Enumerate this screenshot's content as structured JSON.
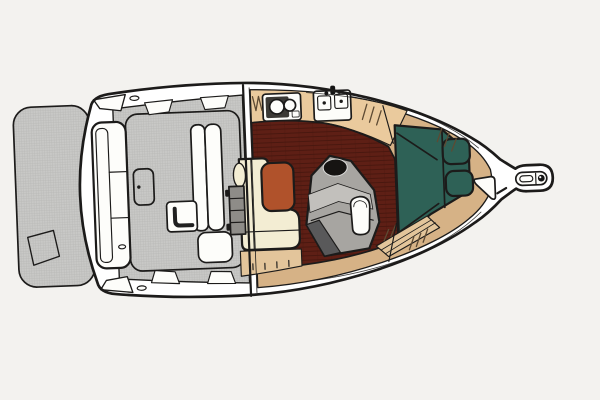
{
  "title": "Motor yacht deck and cabin floor plan (top view)",
  "canvas": {
    "width": 600,
    "height": 400,
    "bg": "#f3f2ef",
    "tilt_deg": -2.2
  },
  "colors": {
    "outline": "#1c1b1a",
    "molding_white": "#ffffff",
    "fixture_white": "#fdfdfa",
    "cockpit_gray": "#c8c8c6",
    "texture_line": "#b2b2b0",
    "salon_floor": "#5e1f15",
    "plank_line": "#45150d",
    "counter_tan": "#eaca9d",
    "deck_tan": "#d6b286",
    "step_tan": "#e3c59b",
    "settee_cream": "#f3edd3",
    "backrest_rust": "#b0522b",
    "vberth_teal": "#2e6156",
    "head_gray": "#a7a5a1",
    "head_gray_light": "#c2c0bc",
    "head_dark": "#59595a",
    "sink_basin_black": "#161412",
    "appliance_dark": "#3c3a36",
    "ladder_gray": "#8e8c88",
    "hatch_tick": "#5d4a33"
  },
  "areas": [
    {
      "id": "swim-platform",
      "label": "Swim platform",
      "color": "cockpit_gray"
    },
    {
      "id": "transom-bench",
      "label": "Transom bench seat",
      "color": "molding_white"
    },
    {
      "id": "cockpit",
      "label": "Aft cockpit with engine hatch",
      "color": "cockpit_gray"
    },
    {
      "id": "cockpit-bench",
      "label": "Cockpit L-shaped bench",
      "color": "fixture_white"
    },
    {
      "id": "companionway",
      "label": "Companionway ladder at bulkhead",
      "color": "ladder_gray"
    },
    {
      "id": "galley",
      "label": "Galley counter with stove and double sink",
      "color": "counter_tan"
    },
    {
      "id": "salon-sole",
      "label": "Salon teak-plank sole",
      "color": "salon_floor"
    },
    {
      "id": "settee",
      "label": "L-shaped settee with rust backrest cushion",
      "color": "settee_cream"
    },
    {
      "id": "head",
      "label": "Head compartment with basin and toilet",
      "color": "head_gray"
    },
    {
      "id": "steps",
      "label": "Steps up to bow cabin",
      "color": "step_tan"
    },
    {
      "id": "v-berth",
      "label": "Bow cabin V-berth with two pillows",
      "color": "vberth_teal"
    },
    {
      "id": "bow-deck",
      "label": "Bow deck liner",
      "color": "deck_tan"
    },
    {
      "id": "bow-hatch",
      "label": "Foredeck hatch",
      "color": "fixture_white"
    },
    {
      "id": "anchor-pulpit",
      "label": "Bow pulpit with anchor roller",
      "color": "molding_white"
    }
  ],
  "fixtures": [
    {
      "id": "stove",
      "label": "Two-burner cooktop"
    },
    {
      "id": "sink",
      "label": "Double galley sink with faucet"
    },
    {
      "id": "head-basin",
      "label": "Head wash basin"
    },
    {
      "id": "toilet",
      "label": "Marine toilet"
    },
    {
      "id": "cleats",
      "label": "Stern deck cleats"
    },
    {
      "id": "anchor",
      "label": "Anchor roller with windlass dot"
    }
  ]
}
